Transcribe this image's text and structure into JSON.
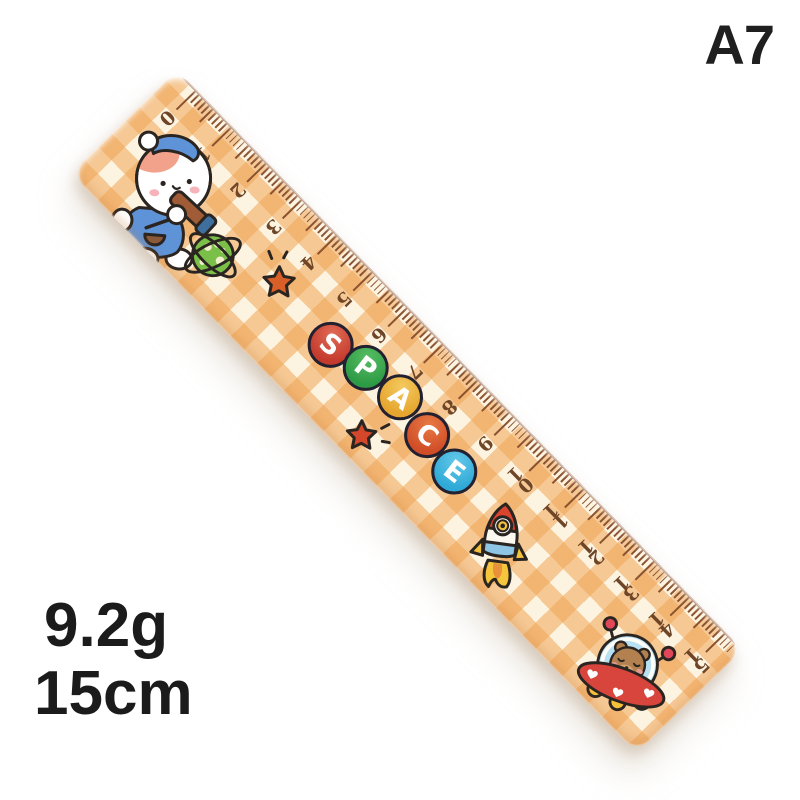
{
  "photo": {
    "background": "#ffffff",
    "variant_label": "A7",
    "weight": "9.2g",
    "length": "15cm"
  },
  "ruler": {
    "theme_word": "SPACE",
    "letters": [
      {
        "char": "S",
        "color": "#c43a2d",
        "light": "#e06a55"
      },
      {
        "char": "P",
        "color": "#2d9b45",
        "light": "#57bd62"
      },
      {
        "char": "A",
        "color": "#e5a52e",
        "light": "#f4c95e"
      },
      {
        "char": "C",
        "color": "#d04d27",
        "light": "#e77a44"
      },
      {
        "char": "E",
        "color": "#2fa9d7",
        "light": "#63c8e8"
      }
    ],
    "scale": {
      "unit": "cm",
      "numbers": [
        "0",
        "1",
        "2",
        "3",
        "4",
        "5",
        "6",
        "7",
        "8",
        "9",
        "10",
        "11",
        "12",
        "13",
        "14",
        "15"
      ],
      "minor_per_cm": 10
    },
    "colors": {
      "gingham_cream": "#fcf3e0",
      "gingham_orange": "#f0a85c",
      "tick": "#8a5230",
      "number": "#6f4527",
      "outline": "#2b2521"
    },
    "stickers": [
      {
        "name": "puppy-astronomer"
      },
      {
        "name": "ringed-planet"
      },
      {
        "name": "sparkle-star-top"
      },
      {
        "name": "sparkle-star-middle"
      },
      {
        "name": "rocket"
      },
      {
        "name": "bear-ufo"
      }
    ]
  }
}
